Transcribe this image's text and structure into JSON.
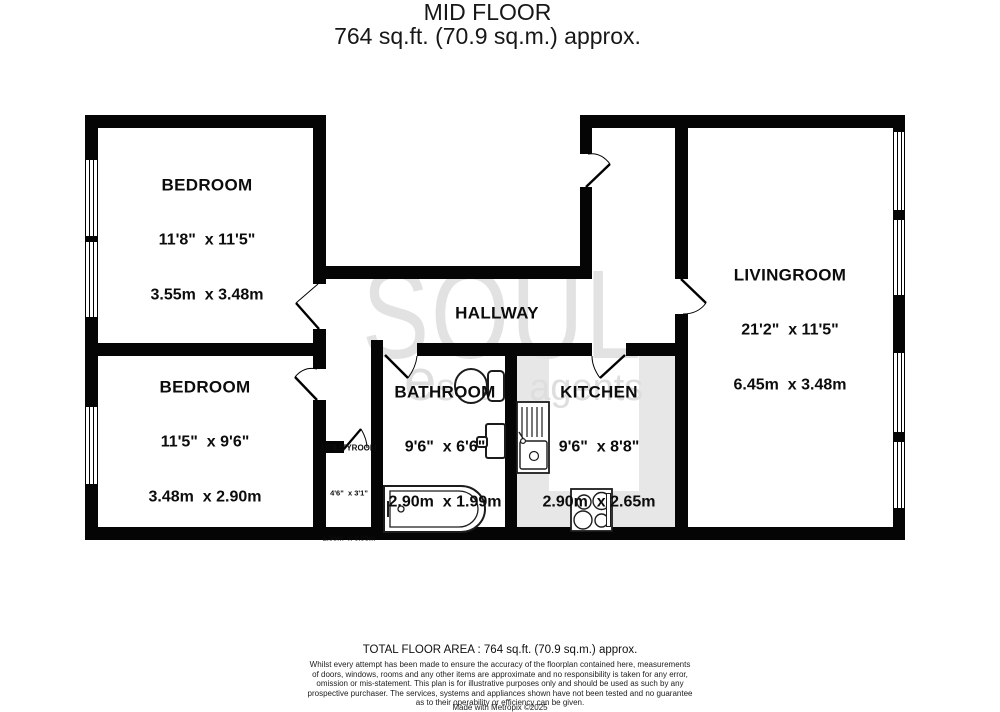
{
  "title": {
    "line1": "MID FLOOR",
    "line2": "764 sq.ft. (70.9 sq.m.) approx."
  },
  "watermark": {
    "brand": "SOUL",
    "tagline_initial": "e",
    "tagline_rest": "state agents"
  },
  "rooms": {
    "bedroom1": {
      "name": "BEDROOM",
      "imperial": "11'8\"  x 11'5\"",
      "metric": "3.55m  x 3.48m"
    },
    "bedroom2": {
      "name": "BEDROOM",
      "imperial": "11'5\"  x 9'6\"",
      "metric": "3.48m  x 2.90m"
    },
    "hallway": {
      "name": "HALLWAY"
    },
    "bathroom": {
      "name": "BATHROOM",
      "imperial": "9'6\"  x 6'6\"",
      "metric": "2.90m  x 1.99m"
    },
    "kitchen": {
      "name": "KITCHEN",
      "imperial": "9'6\"  x 8'8\"",
      "metric": "2.90m  x 2.65m"
    },
    "utilityroom": {
      "name": "UTILITYROOM",
      "imperial": "4'6\"  x 3'1\"",
      "metric": "1.38m  x 0.93m"
    },
    "livingroom": {
      "name": "LIVINGROOM",
      "imperial": "21'2\"  x 11'5\"",
      "metric": "6.45m  x 3.48m"
    }
  },
  "footer": {
    "total_area": "TOTAL FLOOR AREA : 764 sq.ft. (70.9 sq.m.) approx.",
    "disclaimer": "Whilst every attempt has been made to ensure the accuracy of the floorplan contained here, measurements\nof doors, windows, rooms and any other items are approximate and no responsibility is taken for any error,\nomission or mis-statement. This plan is for illustrative purposes only and should be used as such by any\nprospective purchaser. The services, systems and appliances shown have not been tested and no guarantee\nas to their operability or efficiency can be given.",
    "credit": "Made with Metropix ©2025"
  },
  "colors": {
    "wall": "#050505",
    "kitchen_floor": "#e7e7e7",
    "watermark": "#e2e2e2",
    "text": "#111111"
  }
}
